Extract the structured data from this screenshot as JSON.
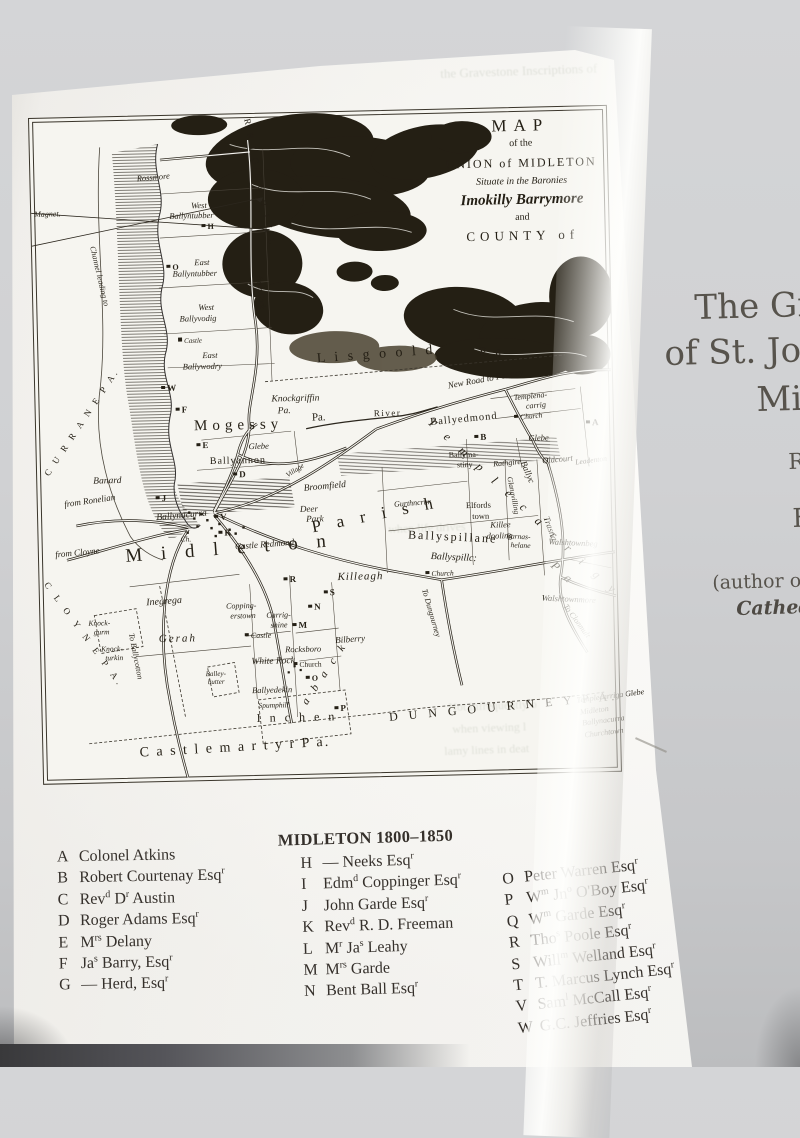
{
  "map": {
    "title_lines": [
      "MAP",
      "of the",
      "UNION of MIDLETON",
      "Situate in the Baronies",
      "Imokilly Barrymore",
      "and",
      "COUNTY of"
    ],
    "labels": [
      {
        "t": "Magnet.",
        "x": 3,
        "y": 92,
        "s": 8,
        "it": 1
      },
      {
        "t": "R R I G T O H I L L",
        "x": 222,
        "y": 4,
        "s": 9,
        "r": 80,
        "ls": 3
      },
      {
        "t": "Rossmore",
        "x": 106,
        "y": 58,
        "s": 8.5,
        "it": 1,
        "r": -4
      },
      {
        "t": "West",
        "x": 160,
        "y": 86,
        "s": 8.5,
        "it": 1
      },
      {
        "t": "Ballyntubber",
        "x": 138,
        "y": 96,
        "s": 8.5,
        "it": 1
      },
      {
        "t": "H",
        "x": 170,
        "y": 108,
        "s": 8,
        "mk": 1
      },
      {
        "t": "O",
        "x": 134,
        "y": 148,
        "s": 8,
        "mk": 1
      },
      {
        "t": "East",
        "x": 162,
        "y": 143,
        "s": 8.5,
        "it": 1
      },
      {
        "t": "Ballyntubber",
        "x": 140,
        "y": 154,
        "s": 8.5,
        "it": 1
      },
      {
        "t": "West",
        "x": 165,
        "y": 188,
        "s": 8.5,
        "it": 1
      },
      {
        "t": "Ballyvodig",
        "x": 146,
        "y": 199,
        "s": 8.5,
        "it": 1
      },
      {
        "t": "Castle",
        "x": 144,
        "y": 222,
        "s": 7,
        "it": 1,
        "sq": 1
      },
      {
        "t": "East",
        "x": 168,
        "y": 236,
        "s": 8.5,
        "it": 1
      },
      {
        "t": "Ballywodry",
        "x": 148,
        "y": 247,
        "s": 8.5,
        "it": 1
      },
      {
        "t": "from Cork",
        "x": 230,
        "y": 162,
        "s": 8,
        "it": 1,
        "r": 85
      },
      {
        "t": "Channel leading to",
        "x": 64,
        "y": 128,
        "s": 8,
        "it": 1,
        "r": 78
      },
      {
        "t": "C U R R A N E   P A.",
        "x": 6,
        "y": 354,
        "s": 9,
        "r": -55,
        "ls": 3
      },
      {
        "t": "C L O Y N E   P A.",
        "x": 10,
        "y": 462,
        "s": 9,
        "r": 55,
        "ls": 4
      },
      {
        "t": "Mogessy",
        "x": 158,
        "y": 304,
        "s": 15,
        "ls": 5
      },
      {
        "t": "Pa.",
        "x": 276,
        "y": 300,
        "s": 11
      },
      {
        "t": "Knockgriffin",
        "x": 236,
        "y": 282,
        "s": 9.5,
        "it": 1
      },
      {
        "t": "Pa.",
        "x": 242,
        "y": 294,
        "s": 9.5,
        "it": 1
      },
      {
        "t": "L i s g o o l d",
        "x": 282,
        "y": 240,
        "s": 14,
        "r": -3,
        "ls": 3
      },
      {
        "t": "P a",
        "x": 445,
        "y": 236,
        "s": 13,
        "ls": 3
      },
      {
        "t": "River",
        "x": 338,
        "y": 298,
        "s": 9,
        "ls": 1.5
      },
      {
        "t": "New Road to Fermoy",
        "x": 412,
        "y": 272,
        "s": 9,
        "it": 1,
        "r": -9
      },
      {
        "t": "B. King",
        "x": 524,
        "y": 258,
        "s": 7,
        "it": 1,
        "r": -6
      },
      {
        "t": "Ballyedmond",
        "x": 394,
        "y": 308,
        "s": 10.5,
        "ls": 1,
        "r": -4
      },
      {
        "t": "B",
        "x": 438,
        "y": 324,
        "s": 9,
        "mk": 1
      },
      {
        "t": "Templena-",
        "x": 478,
        "y": 286,
        "s": 8,
        "it": 1,
        "r": -4
      },
      {
        "t": "carrig",
        "x": 490,
        "y": 295,
        "s": 8,
        "it": 1,
        "r": -4
      },
      {
        "t": "Church",
        "x": 478,
        "y": 306,
        "s": 7.5,
        "it": 1,
        "r": -4,
        "sq": 1
      },
      {
        "t": "Glebe",
        "x": 492,
        "y": 326,
        "s": 8.5,
        "it": 1
      },
      {
        "t": "Oldcourt",
        "x": 505,
        "y": 349,
        "s": 8.5,
        "it": 1,
        "r": -4
      },
      {
        "t": "A",
        "x": 550,
        "y": 312,
        "s": 9,
        "mk": 1
      },
      {
        "t": "Leadenton",
        "x": 538,
        "y": 352,
        "s": 7.5,
        "it": 1,
        "r": -6
      },
      {
        "t": "Glebe",
        "x": 212,
        "y": 328,
        "s": 8.5,
        "it": 1
      },
      {
        "t": "E",
        "x": 160,
        "y": 326,
        "s": 9,
        "mk": 1
      },
      {
        "t": "Ballyannon",
        "x": 173,
        "y": 342,
        "s": 10,
        "ls": 1
      },
      {
        "t": "D",
        "x": 196,
        "y": 356,
        "s": 9,
        "mk": 1
      },
      {
        "t": "W",
        "x": 126,
        "y": 268,
        "s": 9,
        "mk": 1
      },
      {
        "t": "F",
        "x": 140,
        "y": 290,
        "s": 9,
        "mk": 1
      },
      {
        "t": "Banard",
        "x": 56,
        "y": 360,
        "s": 9.5,
        "it": 1
      },
      {
        "t": "from Ronelian",
        "x": 26,
        "y": 382,
        "s": 9,
        "it": 1,
        "r": -7
      },
      {
        "t": "from Cloyne",
        "x": 16,
        "y": 432,
        "s": 9,
        "it": 1,
        "r": -4
      },
      {
        "t": "J",
        "x": 118,
        "y": 378,
        "s": 9,
        "mk": 1
      },
      {
        "t": "Ballynacurra",
        "x": 118,
        "y": 398,
        "s": 9.5,
        "it": 1,
        "r": -4
      },
      {
        "t": "V",
        "x": 176,
        "y": 398,
        "s": 9,
        "mk": 1
      },
      {
        "t": "Ch.",
        "x": 142,
        "y": 420,
        "s": 7.5,
        "it": 1
      },
      {
        "t": "K",
        "x": 180,
        "y": 414,
        "s": 9,
        "mk": 1
      },
      {
        "t": "Castle Redmond",
        "x": 196,
        "y": 428,
        "s": 9,
        "it": 1,
        "r": -3
      },
      {
        "t": "M i d l e t o n",
        "x": 86,
        "y": 430,
        "s": 19,
        "ls": 7,
        "r": -3
      },
      {
        "t": "P a r i s h",
        "x": 272,
        "y": 406,
        "s": 17,
        "ls": 6,
        "r": -10
      },
      {
        "t": "Broomfield",
        "x": 266,
        "y": 372,
        "s": 9.5,
        "it": 1,
        "r": -4
      },
      {
        "t": "Deer",
        "x": 262,
        "y": 392,
        "s": 9,
        "it": 1
      },
      {
        "t": "Park",
        "x": 268,
        "y": 402,
        "s": 9,
        "it": 1
      },
      {
        "t": "Village",
        "x": 248,
        "y": 360,
        "s": 7,
        "it": 1,
        "r": -32
      },
      {
        "t": "Gurthncrur",
        "x": 356,
        "y": 390,
        "s": 8,
        "it": 1,
        "r": -3
      },
      {
        "t": "Elfords",
        "x": 428,
        "y": 392,
        "s": 8.5
      },
      {
        "t": "town",
        "x": 434,
        "y": 403,
        "s": 8.5
      },
      {
        "t": "Killee",
        "x": 452,
        "y": 412,
        "s": 8.5,
        "it": 1
      },
      {
        "t": "dooling",
        "x": 448,
        "y": 423,
        "s": 8.5,
        "it": 1
      },
      {
        "t": "Ballyma-",
        "x": 412,
        "y": 342,
        "s": 8
      },
      {
        "t": "stiny",
        "x": 420,
        "y": 352,
        "s": 8
      },
      {
        "t": "Rathgire",
        "x": 456,
        "y": 352,
        "s": 8,
        "it": 1,
        "r": -4
      },
      {
        "t": "T e m p l e c a r r i g y",
        "x": 398,
        "y": 306,
        "s": 12,
        "ls": 6,
        "r": 44,
        "it": 1
      },
      {
        "t": "P a",
        "x": 518,
        "y": 452,
        "s": 12,
        "ls": 4,
        "r": 45,
        "it": 1
      },
      {
        "t": "Ballyc",
        "x": 490,
        "y": 352,
        "s": 9,
        "it": 1,
        "r": 68
      },
      {
        "t": "Glanavilling",
        "x": 476,
        "y": 368,
        "s": 7.5,
        "it": 1,
        "r": 80
      },
      {
        "t": "Trasna",
        "x": 512,
        "y": 408,
        "s": 9,
        "it": 1,
        "r": 72
      },
      {
        "t": "Walshtownbeg",
        "x": 510,
        "y": 430,
        "s": 8.5,
        "it": 1,
        "r": 4
      },
      {
        "t": "Walshtownmore",
        "x": 502,
        "y": 486,
        "s": 8.5,
        "it": 1,
        "r": 4
      },
      {
        "t": "To Clonmult",
        "x": 528,
        "y": 496,
        "s": 8,
        "it": 1,
        "r": 55
      },
      {
        "t": "Ballyspillane",
        "x": 370,
        "y": 418,
        "s": 12,
        "ls": 2,
        "r": 4
      },
      {
        "t": "Ballyspillc:",
        "x": 392,
        "y": 442,
        "s": 10,
        "it": 1,
        "r": 4
      },
      {
        "t": "Barnas-",
        "x": 468,
        "y": 424,
        "s": 7.5,
        "it": 1,
        "r": 4
      },
      {
        "t": "helane",
        "x": 472,
        "y": 433,
        "s": 7.5,
        "it": 1,
        "r": 4
      },
      {
        "t": "Killeagh",
        "x": 298,
        "y": 460,
        "s": 11,
        "it": 1,
        "ls": 1
      },
      {
        "t": "Church",
        "x": 386,
        "y": 460,
        "s": 7.5,
        "it": 1,
        "sq": 1
      },
      {
        "t": "R",
        "x": 244,
        "y": 462,
        "s": 9,
        "mk": 1
      },
      {
        "t": "S",
        "x": 284,
        "y": 476,
        "s": 9,
        "mk": 1
      },
      {
        "t": "N",
        "x": 268,
        "y": 490,
        "s": 9,
        "mk": 1
      },
      {
        "t": "M",
        "x": 252,
        "y": 508,
        "s": 9,
        "mk": 1
      },
      {
        "t": "Inegrega",
        "x": 106,
        "y": 482,
        "s": 10,
        "it": 1,
        "r": -3
      },
      {
        "t": "Gerah",
        "x": 118,
        "y": 518,
        "s": 11,
        "it": 1,
        "ls": 2
      },
      {
        "t": "Knock-",
        "x": 48,
        "y": 502,
        "s": 7.5,
        "it": 1
      },
      {
        "t": "gurm",
        "x": 53,
        "y": 511,
        "s": 7.5,
        "it": 1
      },
      {
        "t": "Knock-",
        "x": 60,
        "y": 528,
        "s": 7.5,
        "it": 1
      },
      {
        "t": "turkin",
        "x": 64,
        "y": 537,
        "s": 7.5,
        "it": 1
      },
      {
        "t": "To Ballycotton",
        "x": 94,
        "y": 516,
        "s": 8,
        "it": 1,
        "r": 80
      },
      {
        "t": "Copping-",
        "x": 186,
        "y": 488,
        "s": 8,
        "it": 1
      },
      {
        "t": "erstown",
        "x": 190,
        "y": 498,
        "s": 8,
        "it": 1
      },
      {
        "t": "Carrig-",
        "x": 226,
        "y": 498,
        "s": 8,
        "it": 1
      },
      {
        "t": "shine",
        "x": 230,
        "y": 508,
        "s": 8,
        "it": 1
      },
      {
        "t": "Castle",
        "x": 204,
        "y": 518,
        "s": 8,
        "it": 1,
        "sq": 1
      },
      {
        "t": "White Rock",
        "x": 210,
        "y": 544,
        "s": 9.5,
        "it": 1
      },
      {
        "t": "Balley-",
        "x": 164,
        "y": 556,
        "s": 7,
        "it": 1
      },
      {
        "t": "butter",
        "x": 166,
        "y": 564,
        "s": 7,
        "it": 1
      },
      {
        "t": "Ballyedekin",
        "x": 210,
        "y": 572,
        "s": 8.5,
        "it": 1
      },
      {
        "t": "Spumphill",
        "x": 216,
        "y": 588,
        "s": 7.5,
        "it": 1
      },
      {
        "t": "I n c h e n",
        "x": 214,
        "y": 598,
        "s": 12,
        "ls": 3
      },
      {
        "t": "a b a c k",
        "x": 258,
        "y": 588,
        "s": 11,
        "ls": 4,
        "r": -55,
        "it": 1
      },
      {
        "t": "P",
        "x": 292,
        "y": 592,
        "s": 9,
        "mk": 1
      },
      {
        "t": "Rocksboro",
        "x": 244,
        "y": 532,
        "s": 8.5,
        "it": 1
      },
      {
        "t": "Church",
        "x": 252,
        "y": 548,
        "s": 7.5,
        "sq": 1
      },
      {
        "t": "O",
        "x": 264,
        "y": 562,
        "s": 8,
        "mk": 1
      },
      {
        "t": "Bilberry",
        "x": 294,
        "y": 524,
        "s": 9,
        "it": 1,
        "r": -3
      },
      {
        "t": "To Dungourney",
        "x": 388,
        "y": 478,
        "s": 8,
        "it": 1,
        "r": 75
      },
      {
        "t": "D U N G O U R N E Y   P A.",
        "x": 346,
        "y": 600,
        "s": 12,
        "ls": 4,
        "r": -4
      },
      {
        "t": "C a s t l e m a r t y r    P a.",
        "x": 96,
        "y": 630,
        "s": 14,
        "ls": 2,
        "r": -2
      },
      {
        "t": "Templecarriga Glebe",
        "x": 534,
        "y": 590,
        "s": 8,
        "it": 1,
        "r": -6
      },
      {
        "t": "Midleton",
        "x": 537,
        "y": 602,
        "s": 8,
        "it": 1,
        "r": -6
      },
      {
        "t": "Ballynacurra",
        "x": 539,
        "y": 613,
        "s": 8,
        "it": 1,
        "r": -6
      },
      {
        "t": "Churchtown",
        "x": 541,
        "y": 625,
        "s": 8,
        "it": 1,
        "r": -6
      }
    ]
  },
  "legend": {
    "col1": {
      "rows": [
        [
          "A",
          "Colonel Atkins"
        ],
        [
          "B",
          "Robert Courtenay Esq^r"
        ],
        [
          "C",
          "Rev^d D^r Austin"
        ],
        [
          "D",
          "Roger Adams Esq^r"
        ],
        [
          "E",
          "M^rs Delany"
        ],
        [
          "F",
          "Ja^s Barry, Esq^r"
        ],
        [
          "G",
          "— Herd, Esq^r"
        ]
      ]
    },
    "col2": {
      "header": "MIDLETON 1800–1850",
      "rows": [
        [
          "H",
          "— Neeks Esq^r"
        ],
        [
          "I",
          "Edm^d Coppinger Esq^r"
        ],
        [
          "J",
          "John Garde Esq^r"
        ],
        [
          "K",
          "Rev^d R. D. Freeman"
        ],
        [
          "L",
          "M^r Ja^s Leahy"
        ],
        [
          "M",
          "M^rs Garde"
        ],
        [
          "N",
          "Bent Ball Esq^r"
        ]
      ]
    },
    "col3": {
      "rows": [
        [
          "O",
          "Peter Warren Esq^r"
        ],
        [
          "P",
          "W^m Jn^o O'Boy Esq^r"
        ],
        [
          "Q",
          "W^m Garde Esq^r"
        ],
        [
          "R",
          "Tho^s Poole Esq^r"
        ],
        [
          "S",
          "Will^m Welland Esq^r"
        ],
        [
          "T",
          "T. Marcus Lynch Esq^r"
        ],
        [
          "V",
          "Sam^l McCall Esq^r"
        ],
        [
          "W",
          "G.C. Jeffries Esq^r"
        ]
      ]
    }
  },
  "right_page": {
    "lines": [
      {
        "t": "The Grav",
        "x": 694,
        "y": 288,
        "s": 34
      },
      {
        "t": "of St. John",
        "x": 664,
        "y": 334,
        "s": 34
      },
      {
        "t": "Mic",
        "x": 756,
        "y": 380,
        "s": 34
      },
      {
        "t": "R",
        "x": 788,
        "y": 450,
        "s": 22
      },
      {
        "t": "F",
        "x": 792,
        "y": 504,
        "s": 26
      },
      {
        "t": "(author of",
        "x": 712,
        "y": 572,
        "s": 19
      },
      {
        "t": "Cathedr",
        "x": 736,
        "y": 598,
        "s": 19,
        "it": 1
      }
    ]
  },
  "bleed_text": [
    {
      "t": "the Gravestone Inscriptions of",
      "x": 440,
      "y": 66,
      "s": 13,
      "r": -2
    },
    {
      "t": "when life drives",
      "x": 388,
      "y": 522,
      "s": 12,
      "r": -2
    },
    {
      "t": "Not infrequently o",
      "x": 448,
      "y": 700,
      "s": 12,
      "r": -2
    },
    {
      "t": "when viewing l",
      "x": 452,
      "y": 722,
      "s": 12,
      "r": -2
    },
    {
      "t": "lamy lines in deat",
      "x": 444,
      "y": 744,
      "s": 12,
      "r": -2
    }
  ]
}
